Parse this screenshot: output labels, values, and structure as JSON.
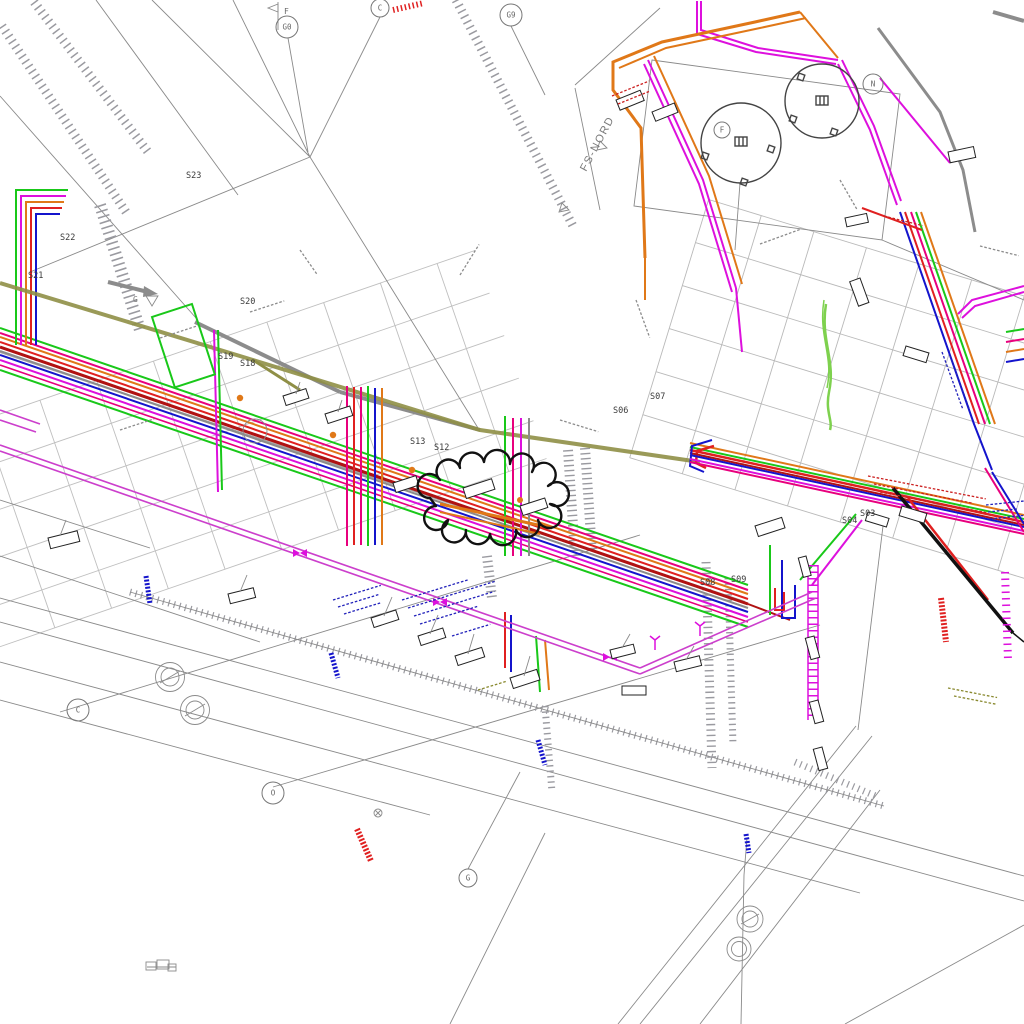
{
  "drawing": {
    "area_label": "FS-NORD",
    "flag_label": "F",
    "arrow_label": "G",
    "stations": [
      {
        "id": "S23",
        "x": 186,
        "y": 178
      },
      {
        "id": "S22",
        "x": 60,
        "y": 240
      },
      {
        "id": "S21",
        "x": 28,
        "y": 278
      },
      {
        "id": "S20",
        "x": 240,
        "y": 304
      },
      {
        "id": "S19",
        "x": 218,
        "y": 359
      },
      {
        "id": "S18",
        "x": 240,
        "y": 366
      },
      {
        "id": "S13",
        "x": 410,
        "y": 444
      },
      {
        "id": "S12",
        "x": 434,
        "y": 450
      },
      {
        "id": "S08",
        "x": 700,
        "y": 585
      },
      {
        "id": "S09",
        "x": 731,
        "y": 582
      },
      {
        "id": "S07",
        "x": 650,
        "y": 399
      },
      {
        "id": "S06",
        "x": 613,
        "y": 413
      },
      {
        "id": "S04",
        "x": 842,
        "y": 523
      },
      {
        "id": "S03",
        "x": 860,
        "y": 516
      }
    ],
    "grid_bubbles": [
      {
        "id": "b1",
        "letter": "G0",
        "x": 287,
        "y": 27,
        "r": 11
      },
      {
        "id": "b2",
        "letter": "C",
        "x": 380,
        "y": 8,
        "r": 9
      },
      {
        "id": "b3",
        "letter": "G9",
        "x": 511,
        "y": 15,
        "r": 11
      },
      {
        "id": "b4",
        "letter": "F",
        "x": 722,
        "y": 130,
        "r": 8
      },
      {
        "id": "b5",
        "letter": "N",
        "x": 873,
        "y": 84,
        "r": 10
      },
      {
        "id": "b6",
        "letter": "C",
        "x": 78,
        "y": 710,
        "r": 11
      },
      {
        "id": "b7",
        "letter": "O",
        "x": 273,
        "y": 793,
        "r": 11
      },
      {
        "id": "b8",
        "letter": "G",
        "x": 468,
        "y": 878,
        "r": 9
      }
    ],
    "colors": {
      "c-green": "#19c819",
      "c-lgreen": "#7ed14e",
      "c-orange": "#e07818",
      "c-red": "#e02020",
      "c-darkred": "#b01212",
      "c-blue": "#1414cc",
      "c-magenta": "#dd10dd",
      "c-pink": "#e8007d",
      "c-violet": "#cc3fcc",
      "c-olive": "#8f8f46",
      "c-gray": "#8c8c8c",
      "c-black": "#111111"
    }
  }
}
